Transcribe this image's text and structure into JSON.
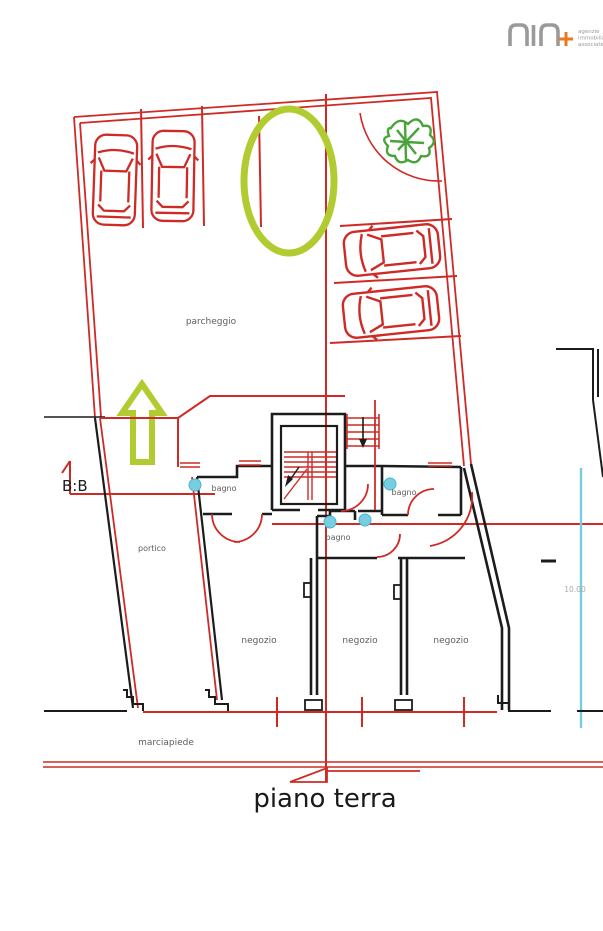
{
  "logo": {
    "tagline": [
      "agenzie",
      "immobiliari",
      "associate"
    ]
  },
  "labels": {
    "parcheggio": "parcheggio",
    "portico": "portico",
    "marciapiede": "marciapiede",
    "bagno_left": "bagno",
    "bagno_center": "bagno",
    "bagno_right": "bagno",
    "negozio_left": "negozio",
    "negozio_center": "negozio",
    "negozio_right": "negozio",
    "section": "B:B",
    "dimension": "10.00",
    "title": "piano terra"
  },
  "colors": {
    "wall_black": "#1c1c1c",
    "plan_red": "#ce2b27",
    "highlight_green": "#b1cc30",
    "tree_green": "#4aa23a",
    "fixture_cyan": "#78cee1",
    "label_gray": "#5d5d5d",
    "logo_gray": "#9a9a9a",
    "logo_orange": "#e87a1e"
  }
}
